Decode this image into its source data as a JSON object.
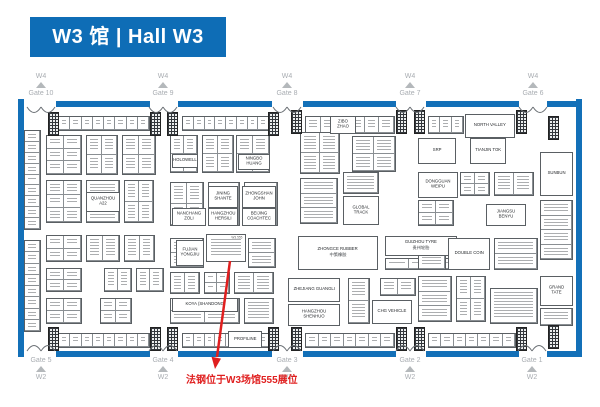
{
  "header": {
    "title": "W3 馆 | Hall W3"
  },
  "annotation": {
    "text": "法钢位于W3场馆555展位",
    "target_booth": "W3.555"
  },
  "colors": {
    "wall_blue": "#1370b8",
    "header_blue": "#0e6db6",
    "gate_gray": "#a9adb2",
    "annotation_red": "#e01f1f"
  },
  "gates": {
    "top_direction": "W4",
    "bottom_direction": "W2",
    "top": [
      {
        "label": "Gate 10",
        "x": 41
      },
      {
        "label": "Gate 9",
        "x": 163
      },
      {
        "label": "Gate 8",
        "x": 287
      },
      {
        "label": "Gate 7",
        "x": 410
      },
      {
        "label": "Gate 6",
        "x": 533
      }
    ],
    "bottom": [
      {
        "label": "Gate 5",
        "x": 41
      },
      {
        "label": "Gate 4",
        "x": 163
      },
      {
        "label": "Gate 3",
        "x": 287
      },
      {
        "label": "Gate 2",
        "x": 410
      },
      {
        "label": "Gate 1",
        "x": 532
      }
    ]
  },
  "walls": {
    "top_y": 101,
    "bottom_y": 351,
    "top_segments": [
      [
        56,
        150
      ],
      [
        178,
        272
      ],
      [
        303,
        396
      ],
      [
        426,
        519
      ],
      [
        547,
        582
      ]
    ],
    "bottom_segments": [
      [
        56,
        150
      ],
      [
        178,
        272
      ],
      [
        303,
        396
      ],
      [
        426,
        519
      ],
      [
        547,
        582
      ]
    ],
    "left": {
      "x": 18,
      "y1": 99,
      "y2": 357
    },
    "right": {
      "x": 576,
      "y1": 99,
      "y2": 357
    }
  },
  "named_booths": [
    {
      "x": 206,
      "y": 234,
      "w": 40,
      "h": 28,
      "name": "",
      "sub": "",
      "num": "W3.555"
    },
    {
      "x": 298,
      "y": 236,
      "w": 80,
      "h": 34,
      "name": "ZHONGCE RUBBER",
      "sub": "中策橡胶",
      "num": ""
    },
    {
      "x": 385,
      "y": 236,
      "w": 72,
      "h": 20,
      "name": "GUIZHOU TYRE",
      "sub": "贵州轮胎",
      "num": ""
    },
    {
      "x": 343,
      "y": 196,
      "w": 36,
      "h": 29,
      "name": "GLOBAL TRACK",
      "sub": "",
      "num": ""
    },
    {
      "x": 418,
      "y": 138,
      "w": 38,
      "h": 26,
      "name": "SRP",
      "sub": "",
      "num": ""
    },
    {
      "x": 470,
      "y": 138,
      "w": 36,
      "h": 26,
      "name": "TIANJIN TOK",
      "sub": "",
      "num": ""
    },
    {
      "x": 418,
      "y": 172,
      "w": 40,
      "h": 26,
      "name": "DONGGUAN WEIPU",
      "sub": "",
      "num": ""
    },
    {
      "x": 486,
      "y": 204,
      "w": 40,
      "h": 22,
      "name": "JIANGSU BENYU",
      "sub": "",
      "num": ""
    },
    {
      "x": 448,
      "y": 238,
      "w": 42,
      "h": 32,
      "name": "DOUBLE COIN",
      "sub": "",
      "num": ""
    },
    {
      "x": 540,
      "y": 152,
      "w": 33,
      "h": 44,
      "name": "SUNBUN",
      "sub": "",
      "num": ""
    },
    {
      "x": 540,
      "y": 276,
      "w": 33,
      "h": 30,
      "name": "GRAND TATE",
      "sub": "",
      "num": ""
    },
    {
      "x": 288,
      "y": 278,
      "w": 52,
      "h": 24,
      "name": "ZHEJIANG GUANGLI",
      "sub": "",
      "num": ""
    },
    {
      "x": 288,
      "y": 304,
      "w": 52,
      "h": 22,
      "name": "HANGZHOU SHENHUO",
      "sub": "",
      "num": ""
    },
    {
      "x": 372,
      "y": 300,
      "w": 40,
      "h": 24,
      "name": "CHG VEHICLE",
      "sub": "",
      "num": ""
    },
    {
      "x": 208,
      "y": 186,
      "w": 30,
      "h": 22,
      "name": "JINING SHANTE",
      "sub": "",
      "num": ""
    },
    {
      "x": 242,
      "y": 186,
      "w": 34,
      "h": 22,
      "name": "ZHONGSHAN JOHN",
      "sub": "",
      "num": ""
    },
    {
      "x": 172,
      "y": 208,
      "w": 34,
      "h": 18,
      "name": "NANCHANG ZOLI",
      "sub": "",
      "num": ""
    },
    {
      "x": 208,
      "y": 208,
      "w": 30,
      "h": 18,
      "name": "HANGZHOU HERSILI",
      "sub": "",
      "num": ""
    },
    {
      "x": 242,
      "y": 208,
      "w": 34,
      "h": 18,
      "name": "BEIJING COACHTEC",
      "sub": "",
      "num": ""
    },
    {
      "x": 176,
      "y": 240,
      "w": 28,
      "h": 26,
      "name": "FUJIAN YONGJIU",
      "sub": "",
      "num": ""
    },
    {
      "x": 172,
      "y": 154,
      "w": 26,
      "h": 14,
      "name": "HOLOWELL",
      "sub": "",
      "num": ""
    },
    {
      "x": 238,
      "y": 154,
      "w": 32,
      "h": 16,
      "name": "NINGBO HUANG",
      "sub": "",
      "num": ""
    },
    {
      "x": 465,
      "y": 114,
      "w": 50,
      "h": 24,
      "name": "NORTH VALLEY",
      "sub": "",
      "num": ""
    },
    {
      "x": 330,
      "y": 116,
      "w": 26,
      "h": 18,
      "name": "ZIBO ZHAO",
      "sub": "",
      "num": ""
    },
    {
      "x": 228,
      "y": 331,
      "w": 34,
      "h": 17,
      "name": "PROFILINE",
      "sub": "",
      "num": ""
    },
    {
      "x": 172,
      "y": 298,
      "w": 66,
      "h": 14,
      "name": "KOYA (SHANDONG)",
      "sub": "",
      "num": ""
    },
    {
      "x": 86,
      "y": 192,
      "w": 34,
      "h": 20,
      "name": "QUANZHOU A22",
      "sub": "",
      "num": ""
    }
  ],
  "noise_blocks": [
    [
      58,
      116,
      92,
      15,
      8,
      1
    ],
    [
      182,
      116,
      88,
      15,
      8,
      1
    ],
    [
      305,
      116,
      90,
      18,
      6,
      1
    ],
    [
      428,
      116,
      36,
      18,
      3,
      1
    ],
    [
      58,
      333,
      92,
      15,
      8,
      1
    ],
    [
      182,
      333,
      88,
      15,
      8,
      1
    ],
    [
      305,
      333,
      90,
      15,
      7,
      1
    ],
    [
      428,
      333,
      88,
      15,
      7,
      1
    ],
    [
      24,
      130,
      17,
      100,
      1,
      9
    ],
    [
      24,
      240,
      17,
      92,
      1,
      8
    ],
    [
      540,
      200,
      33,
      60,
      1,
      4
    ],
    [
      540,
      308,
      33,
      18,
      1,
      1
    ],
    [
      46,
      135,
      36,
      40,
      2,
      3
    ],
    [
      86,
      135,
      32,
      40,
      2,
      2
    ],
    [
      122,
      135,
      34,
      40,
      2,
      2
    ],
    [
      46,
      180,
      36,
      43,
      2,
      3
    ],
    [
      86,
      180,
      34,
      43,
      1,
      2
    ],
    [
      124,
      180,
      30,
      43,
      2,
      2
    ],
    [
      46,
      235,
      36,
      27,
      2,
      2
    ],
    [
      86,
      235,
      34,
      27,
      2,
      1
    ],
    [
      124,
      235,
      31,
      27,
      2,
      1
    ],
    [
      46,
      268,
      36,
      24,
      2,
      2
    ],
    [
      104,
      268,
      28,
      24,
      2,
      1
    ],
    [
      136,
      268,
      28,
      24,
      2,
      1
    ],
    [
      46,
      298,
      36,
      26,
      2,
      2
    ],
    [
      100,
      298,
      32,
      26,
      2,
      2
    ],
    [
      170,
      135,
      28,
      38,
      2,
      2
    ],
    [
      202,
      135,
      32,
      38,
      2,
      2
    ],
    [
      236,
      135,
      34,
      38,
      2,
      2
    ],
    [
      170,
      182,
      34,
      44,
      2,
      2
    ],
    [
      208,
      182,
      32,
      44,
      1,
      2
    ],
    [
      244,
      182,
      34,
      44,
      1,
      2
    ],
    [
      170,
      238,
      34,
      30,
      1,
      2
    ],
    [
      248,
      238,
      28,
      30,
      1,
      2
    ],
    [
      170,
      272,
      30,
      22,
      2,
      1
    ],
    [
      204,
      272,
      26,
      22,
      2,
      2
    ],
    [
      234,
      272,
      40,
      22,
      2,
      1
    ],
    [
      170,
      298,
      70,
      26,
      2,
      2
    ],
    [
      244,
      298,
      30,
      26,
      1,
      1
    ],
    [
      300,
      132,
      40,
      42,
      2,
      2
    ],
    [
      352,
      136,
      44,
      36,
      2,
      2
    ],
    [
      300,
      178,
      38,
      46,
      1,
      3
    ],
    [
      343,
      172,
      36,
      22,
      1,
      1
    ],
    [
      348,
      278,
      22,
      46,
      1,
      2
    ],
    [
      380,
      278,
      36,
      18,
      2,
      1
    ],
    [
      385,
      258,
      72,
      12,
      3,
      1
    ],
    [
      460,
      172,
      30,
      24,
      2,
      2
    ],
    [
      494,
      172,
      40,
      24,
      2,
      1
    ],
    [
      418,
      200,
      36,
      26,
      2,
      2
    ],
    [
      418,
      238,
      28,
      32,
      1,
      2
    ],
    [
      494,
      238,
      44,
      32,
      1,
      2
    ],
    [
      418,
      276,
      34,
      46,
      1,
      3
    ],
    [
      456,
      276,
      30,
      46,
      2,
      2
    ],
    [
      490,
      288,
      48,
      36,
      1,
      1
    ]
  ],
  "end_caps": {
    "top": [
      [
        48,
        112
      ],
      [
        150,
        112
      ],
      [
        167,
        112
      ],
      [
        268,
        112
      ],
      [
        291,
        110
      ],
      [
        396,
        110
      ],
      [
        414,
        110
      ],
      [
        516,
        110
      ],
      [
        548,
        116
      ]
    ],
    "bottom": [
      [
        48,
        327
      ],
      [
        150,
        327
      ],
      [
        167,
        327
      ],
      [
        268,
        327
      ],
      [
        291,
        327
      ],
      [
        396,
        327
      ],
      [
        414,
        327
      ],
      [
        516,
        327
      ],
      [
        548,
        325
      ]
    ]
  },
  "arrow": {
    "x1": 230,
    "y1": 261,
    "x2": 217,
    "y2": 357,
    "head": "215,369 211.5,356.8 221,358.6"
  }
}
